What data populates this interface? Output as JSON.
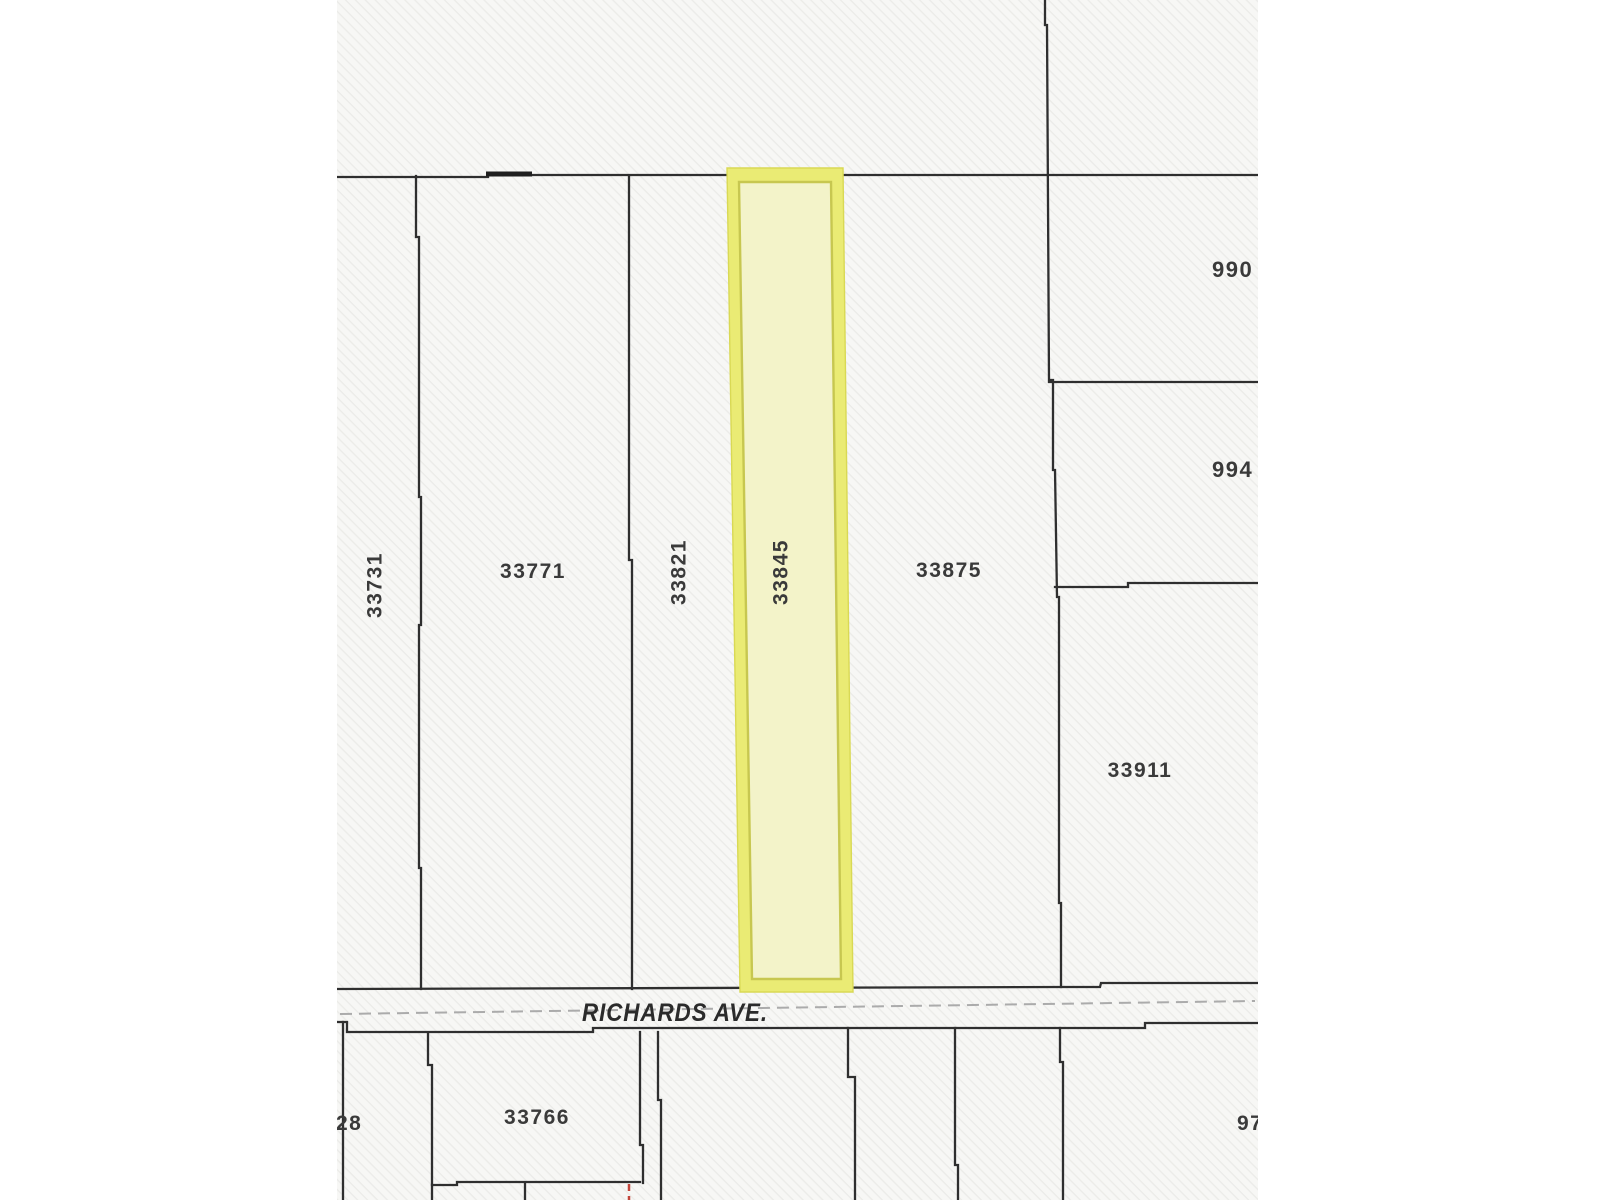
{
  "labels": {
    "p33731": "33731",
    "p33771": "33771",
    "p33821": "33821",
    "p33845": "33845",
    "p33875": "33875",
    "p990": "990",
    "p994": "994",
    "p33911": "33911",
    "p33766": "33766",
    "p28": "28",
    "p97": "97",
    "street": "RICHARDS AVE."
  },
  "highlighted_parcel": "33845",
  "colors": {
    "boundary": "#2f2f2f",
    "highlight_band": "#eaeb74",
    "highlight_band_edge": "#d9d954",
    "highlight_fill": "#f3f3c9",
    "highlight_inner_edge": "#c7c750",
    "street_centerline": "#ababab",
    "red_dash": "#c2453a",
    "label": "#3a3a3a"
  }
}
